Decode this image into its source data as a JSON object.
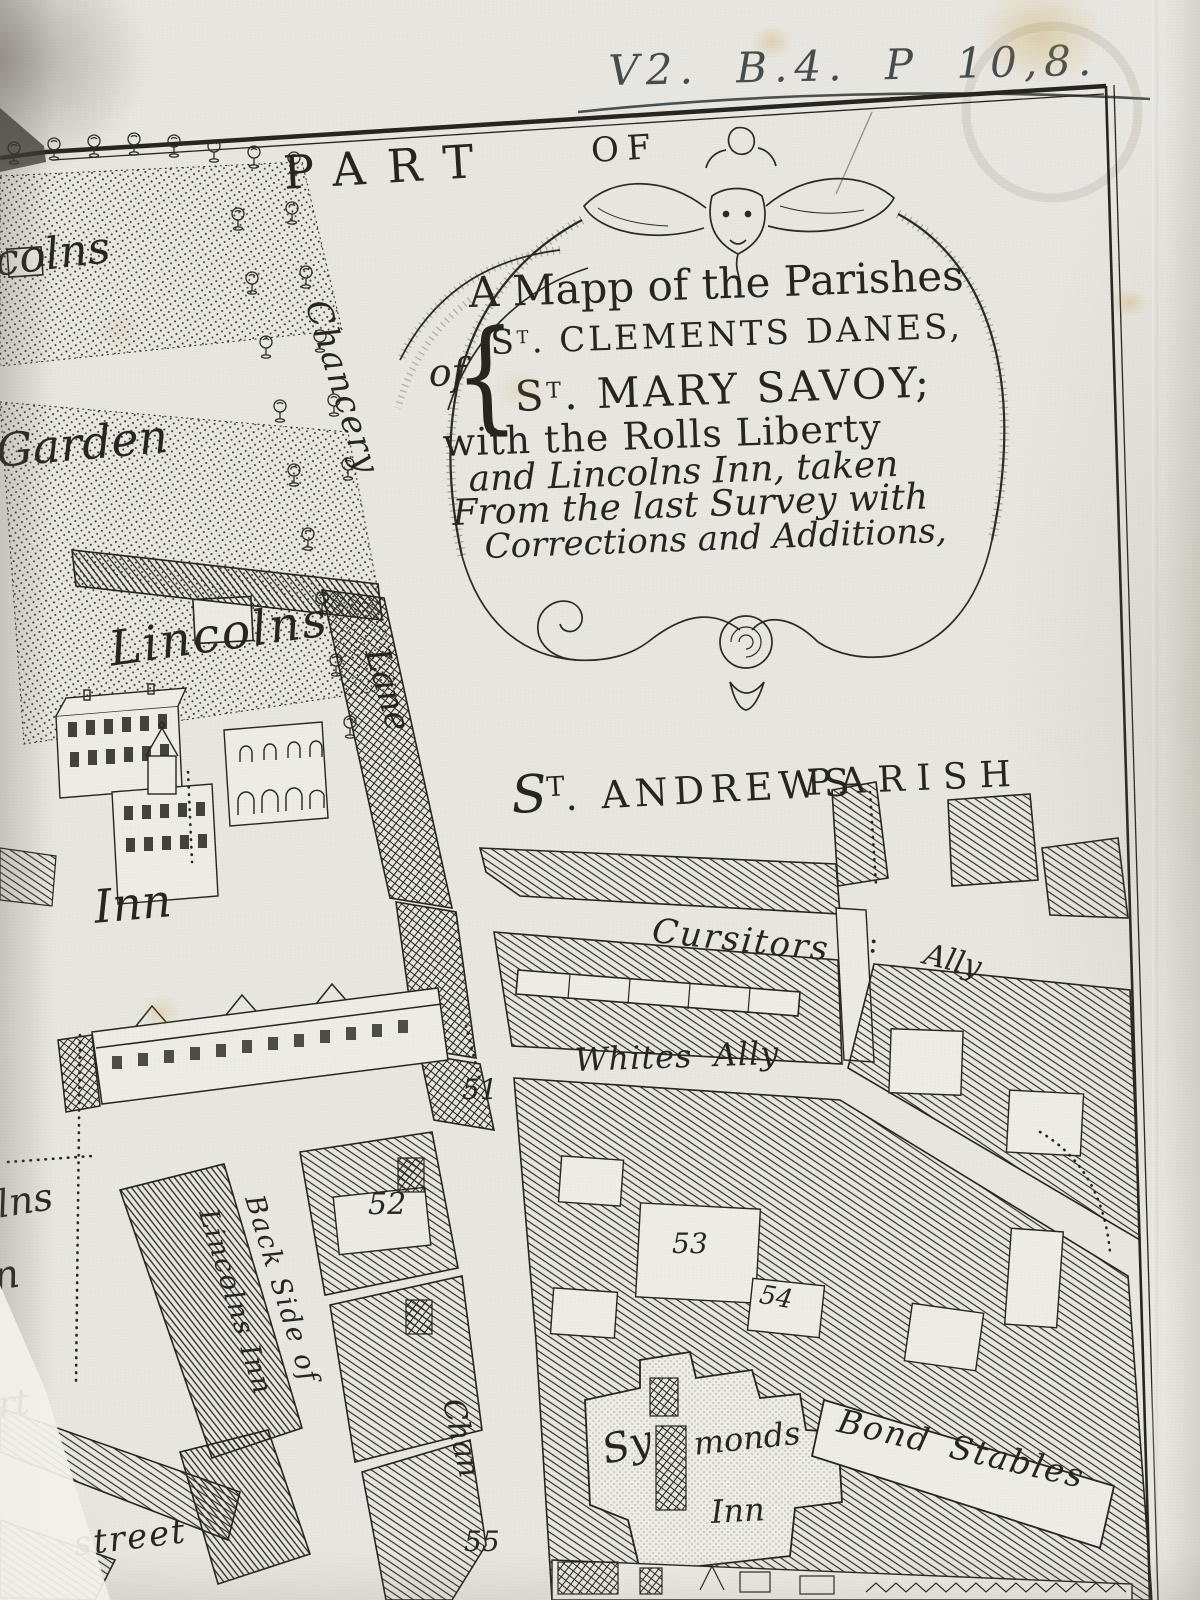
{
  "colors": {
    "paper": "#e9e7e1",
    "ink": "#26241d",
    "handwriting_ink": "#454c4c"
  },
  "annotation": "V2. B.4. P 10,8.",
  "top_banner": {
    "part": "PART",
    "of": "OF"
  },
  "cartouche": {
    "line1": "A Mapp of the Parishes",
    "of_word": "of",
    "brace": "{",
    "clements": {
      "s": "S",
      "sup": "T",
      "rest": ". CLEMENTS DANES,"
    },
    "mary": {
      "s": "S",
      "sup": "T",
      "rest": ". MARY SAVOY;"
    },
    "line_rolls": "with the Rolls Liberty",
    "line_taken": "and Lincolns Inn, taken",
    "line_survey": "From the last Survey with",
    "line_corrections": "Corrections and Additions,"
  },
  "streets": {
    "chancery": "Chancery",
    "lane": "Lane",
    "chan": "Chan",
    "cursitors": "Cursitors",
    "colon": ":",
    "ally": "Ally",
    "whites_ally": "Whites Ally",
    "back_side_1": "Back Side of",
    "back_side_2": "Lincolns Inn",
    "street": "street"
  },
  "places": {
    "lincolns": "Lincolns",
    "inn": "Inn",
    "garden": "Garden",
    "andrews": {
      "s": "S",
      "sup": "T",
      "rest": ". ANDREWS"
    },
    "parish": "PARISH",
    "symonds_1": "Sy",
    "symonds_2": "monds",
    "symonds_3": "Inn",
    "bond_stables": "Bond Stables",
    "partial_colns": "colns",
    "partial_lns": "lns",
    "partial_n": "n",
    "partial_rt": "rt"
  },
  "numbers": {
    "n51": "51",
    "n52": "52",
    "n53": "53",
    "n54": "54",
    "n55": "55"
  }
}
